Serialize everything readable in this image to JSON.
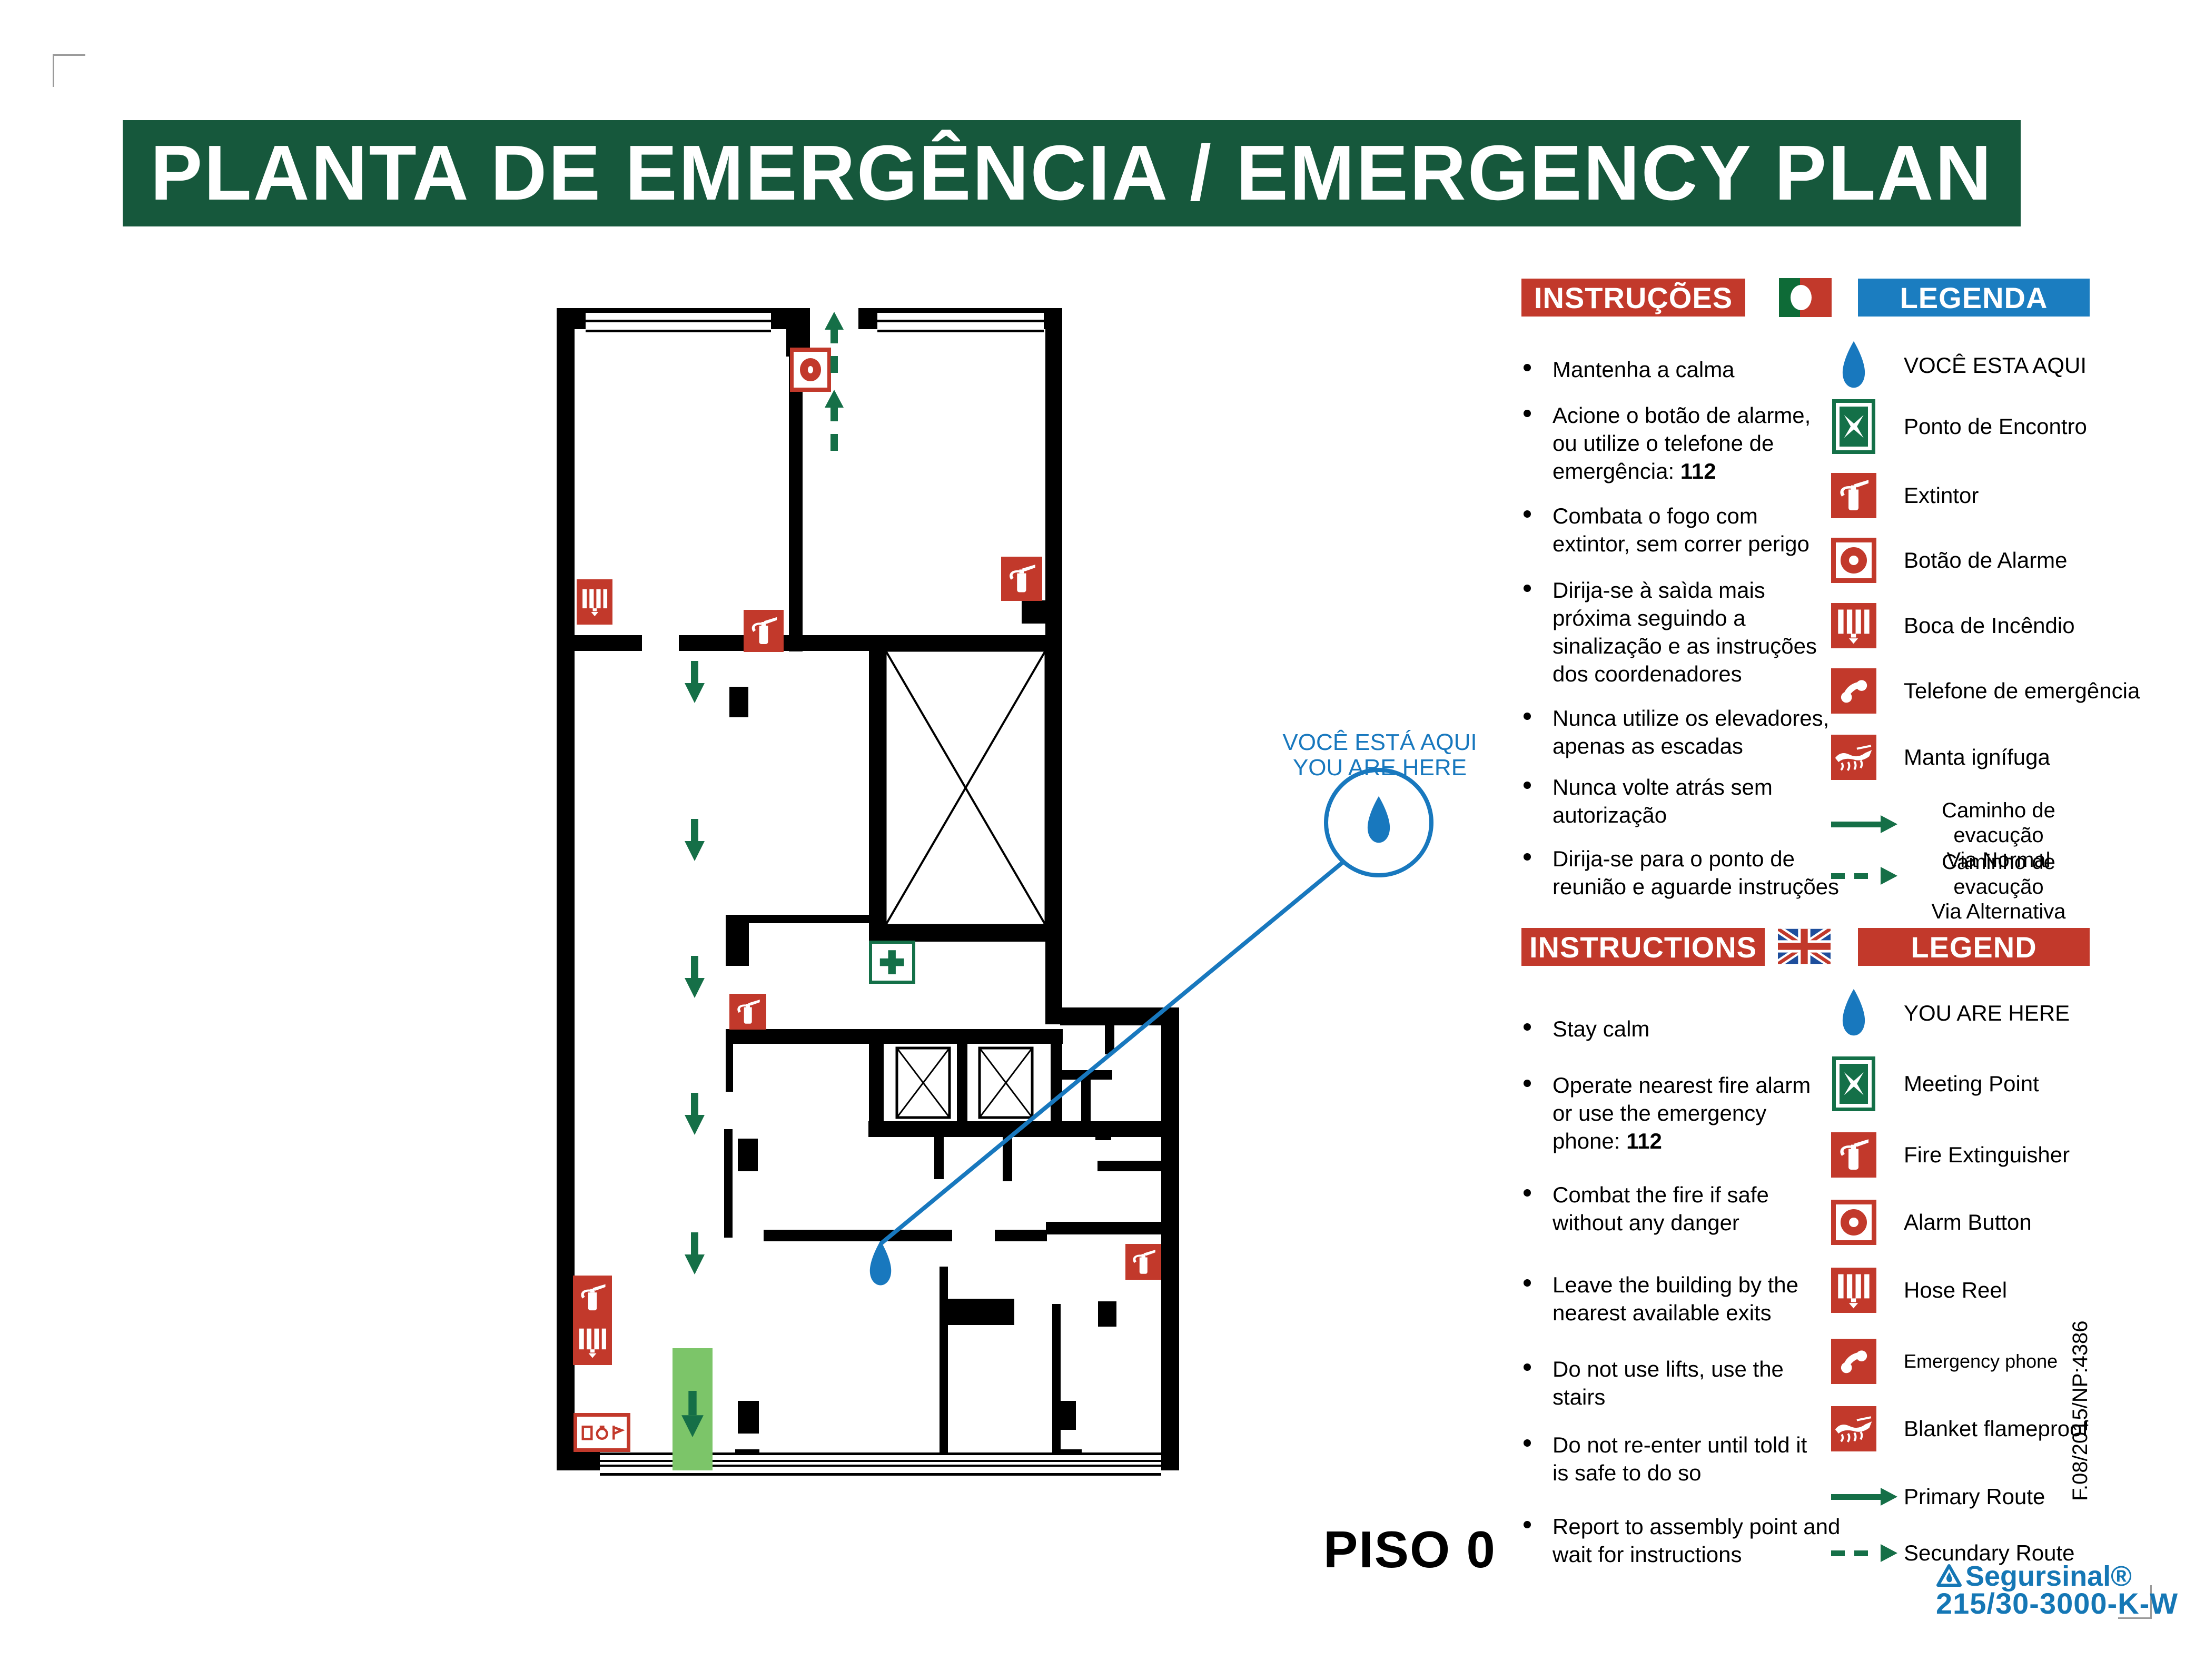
{
  "title": "PLANTA DE EMERGÊNCIA / EMERGENCY PLAN",
  "floor_label": "PISO 0",
  "callout": {
    "line1": "VOCÊ ESTÁ AQUI",
    "line2": "YOU ARE HERE"
  },
  "sections": {
    "pt": {
      "instructions_title": "INSTRUÇÕES",
      "legend_title": "LEGENDA",
      "instructions": [
        {
          "lines": [
            "Mantenha a calma"
          ]
        },
        {
          "lines": [
            "Acione o botão de alarme,",
            "ou utilize o telefone de",
            "emergência: "
          ],
          "bold": "112"
        },
        {
          "lines": [
            "Combata o fogo com",
            "extintor, sem correr perigo"
          ]
        },
        {
          "lines": [
            "Dirija-se à saìda mais",
            "próxima seguindo a",
            "sinalização e as instruções",
            "dos coordenadores"
          ]
        },
        {
          "lines": [
            "Nunca utilize os elevadores,",
            "apenas as escadas"
          ]
        },
        {
          "lines": [
            "Nunca volte atrás sem",
            "autorização"
          ]
        },
        {
          "lines": [
            "Dirija-se para o ponto de",
            "reunião e aguarde instruções"
          ]
        }
      ],
      "legend": [
        {
          "icon": "you-are-here-drop-icon",
          "label": "VOCÊ ESTA AQUI"
        },
        {
          "icon": "meeting-point-icon",
          "label": "Ponto de Encontro"
        },
        {
          "icon": "fire-extinguisher-icon",
          "label": "Extintor"
        },
        {
          "icon": "alarm-button-icon",
          "label": "Botão de Alarme"
        },
        {
          "icon": "hose-reel-icon",
          "label": "Boca de Incêndio"
        },
        {
          "icon": "emergency-phone-icon",
          "label": "Telefone de emergência"
        },
        {
          "icon": "fire-blanket-icon",
          "label": "Manta ignífuga"
        },
        {
          "icon": "primary-route-arrow-icon",
          "lines": [
            "Caminho de evacução",
            "Via Normal"
          ]
        },
        {
          "icon": "secondary-route-arrow-icon",
          "lines": [
            "Caminho de evacução",
            "Via Alternativa"
          ]
        }
      ]
    },
    "en": {
      "instructions_title": "INSTRUCTIONS",
      "legend_title": "LEGEND",
      "instructions": [
        {
          "lines": [
            "Stay calm"
          ]
        },
        {
          "lines": [
            "Operate nearest fire alarm",
            "or use the emergency",
            "phone: "
          ],
          "bold": "112"
        },
        {
          "lines": [
            "Combat the fire if safe",
            "without any danger"
          ]
        },
        {
          "lines": [
            "Leave the building by the",
            "nearest available exits"
          ]
        },
        {
          "lines": [
            "Do not use lifts, use the",
            "stairs"
          ]
        },
        {
          "lines": [
            "Do not re-enter until told it",
            "is safe to do so"
          ]
        },
        {
          "lines": [
            "Report to assembly point and",
            "wait for instructions"
          ]
        }
      ],
      "legend": [
        {
          "icon": "you-are-here-drop-icon",
          "label": "YOU ARE HERE"
        },
        {
          "icon": "meeting-point-icon",
          "label": "Meeting Point"
        },
        {
          "icon": "fire-extinguisher-icon",
          "label": "Fire Extinguisher"
        },
        {
          "icon": "alarm-button-icon",
          "label": "Alarm Button"
        },
        {
          "icon": "hose-reel-icon",
          "label": "Hose Reel"
        },
        {
          "icon": "emergency-phone-icon",
          "label": "Emergency phone"
        },
        {
          "icon": "fire-blanket-icon",
          "label": "Blanket flameproof"
        },
        {
          "icon": "primary-route-arrow-icon",
          "label": "Primary Route"
        },
        {
          "icon": "secondary-route-arrow-icon",
          "label": "Secundary Route"
        }
      ]
    }
  },
  "footer": {
    "brand": "Segursinal®",
    "model": "215/30-3000-K-W",
    "ref_code": "F.08/2015/NP:4386"
  },
  "colors": {
    "banner_green": "#16583C",
    "signal_red": "#C2392B",
    "legend_blue": "#1B7DC0",
    "route_green": "#156F47",
    "door_green": "#7CC569",
    "marker_blue": "#1878BE",
    "brand_blue": "#1577B5"
  }
}
